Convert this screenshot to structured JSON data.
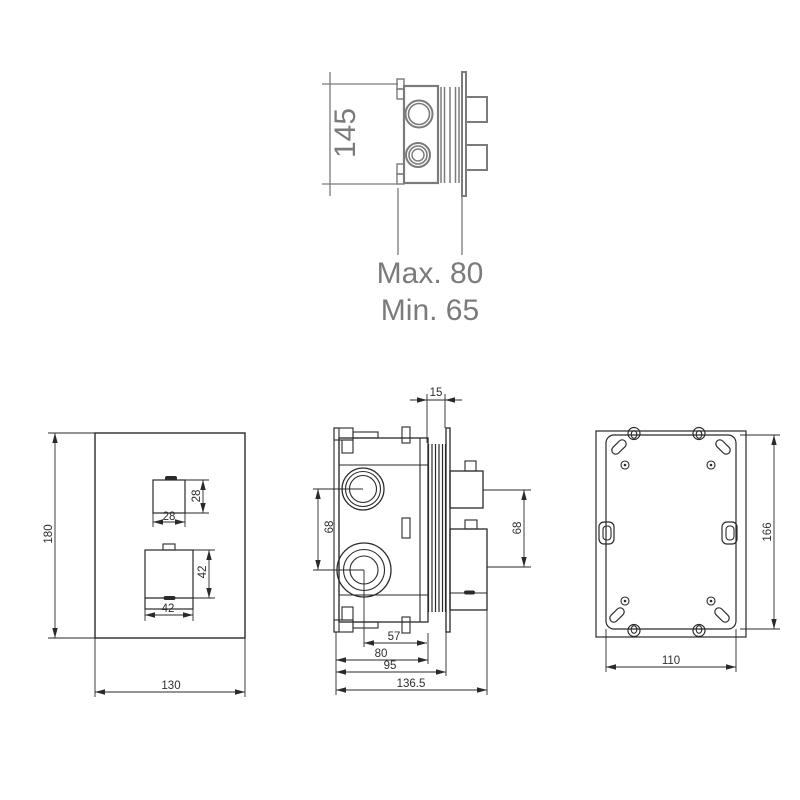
{
  "views": {
    "top": {
      "box_height": "145",
      "depth_max": "Max. 80",
      "depth_min": "Min. 65"
    },
    "front": {
      "plate_height": "180",
      "plate_width": "130",
      "knob_small_width": "28",
      "knob_small_height": "28",
      "knob_large_width": "42",
      "knob_large_height": "42"
    },
    "side": {
      "trim_thickness": "15",
      "port_spacing": "68",
      "handle_spacing": "68",
      "center_to_face": "57",
      "body_depth": "80",
      "depth_with_trim": "95",
      "overall_depth": "136.5"
    },
    "back": {
      "box_width": "110",
      "box_height": "166"
    }
  },
  "colors": {
    "secondary_view": "#7b7b7b",
    "primary_lines": "#2a2a2a",
    "dimension_text": "#2f2f2f",
    "background": "#ffffff"
  }
}
